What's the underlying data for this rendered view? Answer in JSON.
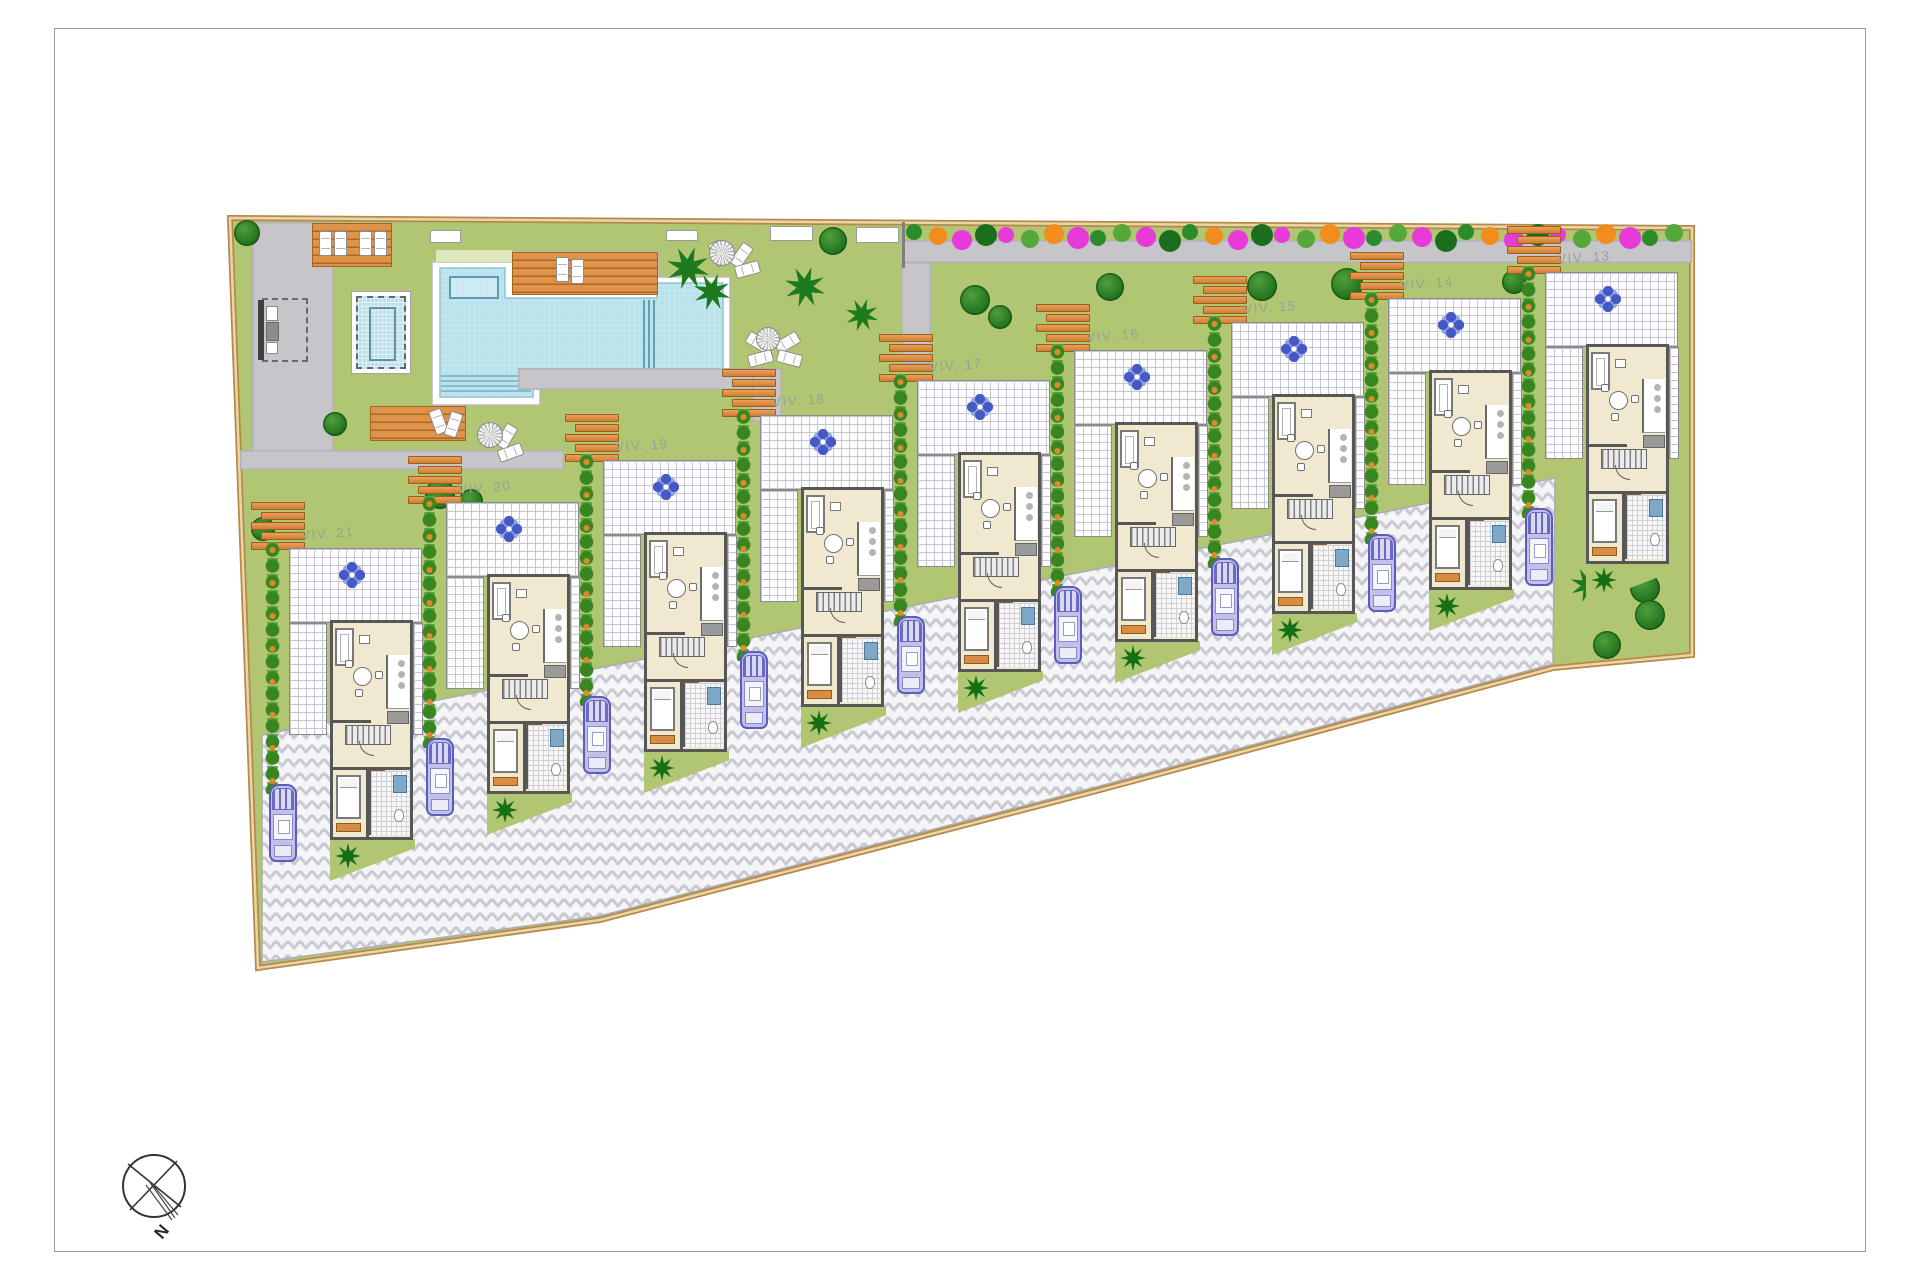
{
  "document": {
    "kind": "residential-site-plan",
    "compass_label": "N"
  },
  "villas": [
    {
      "label": "VIV. 13",
      "x": 1521,
      "y": 252
    },
    {
      "label": "VIV. 14",
      "x": 1364,
      "y": 278
    },
    {
      "label": "VIV. 15",
      "x": 1207,
      "y": 302
    },
    {
      "label": "VIV. 16",
      "x": 1050,
      "y": 330
    },
    {
      "label": "VIV. 17",
      "x": 893,
      "y": 360
    },
    {
      "label": "VIV. 18",
      "x": 736,
      "y": 395
    },
    {
      "label": "VIV. 19",
      "x": 579,
      "y": 440
    },
    {
      "label": "VIV. 20",
      "x": 422,
      "y": 482
    },
    {
      "label": "VIV. 21",
      "x": 265,
      "y": 528
    }
  ],
  "colors": {
    "lawn": "#b0c672",
    "sidewalk": "#c6c6ca",
    "site_border": "#b8884a",
    "site_border_inner": "#e9d6a8",
    "deck_wood": "#de9348",
    "pool_water": "#b9e2ec",
    "pool_platform": "#ffffff",
    "herringbone_bg": "#f5f5f7",
    "herringbone_line": "#c9c9d2",
    "house_wall": "#575757",
    "house_floor": "#f0e9cf",
    "hedge_green": "#37861f",
    "hedge_berry_orange": "#dd8a2b",
    "tree_green": "#1e6e1e",
    "car_blue": "#5c5cbc",
    "label_gray": "#98a296",
    "flower_magenta": "#e83ad8",
    "flower_orange": "#f28c1c"
  },
  "icons": {
    "tree": "round-canopy-circle",
    "palm": "star-frond",
    "parasol": "spiral-umbrella",
    "flower_ornament": "blue-four-petal-rosette",
    "car": "top-view-car",
    "compass": "circle-cross-needle"
  },
  "geometry": {
    "site": [
      [
        230,
        218
      ],
      [
        1692,
        228
      ],
      [
        1692,
        655
      ],
      [
        1553,
        668
      ],
      [
        1100,
        790
      ],
      [
        600,
        920
      ],
      [
        258,
        968
      ]
    ],
    "herringbone": [
      [
        262,
        735
      ],
      [
        1555,
        478
      ],
      [
        1553,
        664
      ],
      [
        1100,
        786
      ],
      [
        600,
        916
      ],
      [
        262,
        962
      ]
    ],
    "paths": [
      [
        252,
        222,
        82,
        232
      ],
      [
        240,
        450,
        324,
        20
      ],
      [
        518,
        368,
        236,
        22
      ],
      [
        752,
        368,
        30,
        54
      ],
      [
        903,
        240,
        789,
        23
      ],
      [
        901,
        262,
        30,
        102
      ]
    ],
    "wall": [
      902,
      222,
      3,
      46
    ],
    "pale_strip": [
      436,
      250,
      76,
      12
    ],
    "pool": {
      "platform": [
        [
          432,
          262
        ],
        [
          512,
          262
        ],
        [
          512,
          252
        ],
        [
          658,
          252
        ],
        [
          658,
          277
        ],
        [
          730,
          277
        ],
        [
          730,
          380
        ],
        [
          663,
          380
        ],
        [
          663,
          388
        ],
        [
          540,
          388
        ],
        [
          540,
          405
        ],
        [
          432,
          405
        ]
      ],
      "water": [
        [
          440,
          268
        ],
        [
          505,
          268
        ],
        [
          505,
          298
        ],
        [
          657,
          298
        ],
        [
          657,
          283
        ],
        [
          723,
          283
        ],
        [
          723,
          370
        ],
        [
          663,
          370
        ],
        [
          663,
          373
        ],
        [
          533,
          373
        ],
        [
          533,
          397
        ],
        [
          440,
          397
        ]
      ],
      "kids_rect": [
        450,
        277,
        48,
        21
      ],
      "lanes_x": [
        644,
        649,
        654
      ],
      "lanes_y": [
        300,
        371
      ],
      "steps": {
        "x1": 441,
        "x2": 531,
        "ys": [
          376,
          381,
          386,
          391
        ]
      },
      "small_outer": [
        351,
        291,
        60,
        83
      ],
      "small_inner": [
        368,
        306,
        27,
        54
      ]
    },
    "entrance": {
      "bar": [
        258,
        300,
        6,
        60
      ],
      "dash": [
        262,
        298,
        46,
        64
      ],
      "w1": [
        266,
        306,
        12,
        15
      ],
      "w2": [
        266,
        342,
        12,
        12
      ],
      "dark": [
        266,
        322,
        13,
        19
      ]
    },
    "compass": {
      "cx": 154,
      "cy": 1186,
      "r": 31
    }
  },
  "scatter": {
    "decks": [
      [
        312,
        223,
        80,
        44
      ],
      [
        512,
        252,
        146,
        43
      ],
      [
        370,
        406,
        96,
        35
      ]
    ],
    "benches": [
      [
        430,
        230,
        31,
        13
      ],
      [
        666,
        230,
        32,
        11
      ],
      [
        770,
        226,
        43,
        15
      ],
      [
        856,
        227,
        43,
        16
      ]
    ],
    "loungers": [
      [
        319,
        231,
        0
      ],
      [
        334,
        231,
        0
      ],
      [
        359,
        231,
        0
      ],
      [
        374,
        231,
        0
      ],
      [
        556,
        257,
        0
      ],
      [
        571,
        259,
        0
      ],
      [
        432,
        409,
        -20
      ],
      [
        447,
        412,
        18
      ],
      [
        735,
        243,
        35
      ],
      [
        741,
        257,
        75
      ],
      [
        712,
        241,
        -25
      ],
      [
        752,
        330,
        -60
      ],
      [
        754,
        346,
        -105
      ],
      [
        781,
        330,
        60
      ],
      [
        783,
        346,
        105
      ],
      [
        500,
        424,
        30
      ],
      [
        504,
        440,
        70
      ]
    ],
    "spirals": [
      [
        722,
        253,
        26
      ],
      [
        768,
        339,
        24
      ],
      [
        490,
        435,
        26
      ]
    ],
    "trees": [
      [
        247,
        233,
        26
      ],
      [
        833,
        241,
        28
      ],
      [
        335,
        424,
        24
      ],
      [
        263,
        529,
        24
      ],
      [
        440,
        494,
        30
      ],
      [
        471,
        501,
        24
      ],
      [
        975,
        300,
        30
      ],
      [
        1000,
        317,
        24
      ],
      [
        1110,
        287,
        28
      ],
      [
        1262,
        286,
        30
      ],
      [
        1347,
        284,
        32
      ],
      [
        1514,
        282,
        24
      ],
      [
        1645,
        588,
        30
      ],
      [
        1650,
        615,
        30
      ],
      [
        1607,
        645,
        28
      ]
    ],
    "palms": [
      [
        688,
        268,
        44
      ],
      [
        712,
        292,
        38
      ],
      [
        805,
        287,
        42
      ],
      [
        862,
        315,
        34
      ],
      [
        1588,
        585,
        36
      ]
    ],
    "flower_row": {
      "x0": 906,
      "y": 224,
      "step": 23,
      "count": 34,
      "colors": [
        "#2c8c2c",
        "#f28c1c",
        "#e83ad8",
        "#1b6e1b",
        "#e83ad8",
        "#57a83a",
        "#f28c1c",
        "#e83ad8",
        "#2c8c2c",
        "#57a83a",
        "#e83ad8",
        "#1b6e1b"
      ]
    }
  }
}
